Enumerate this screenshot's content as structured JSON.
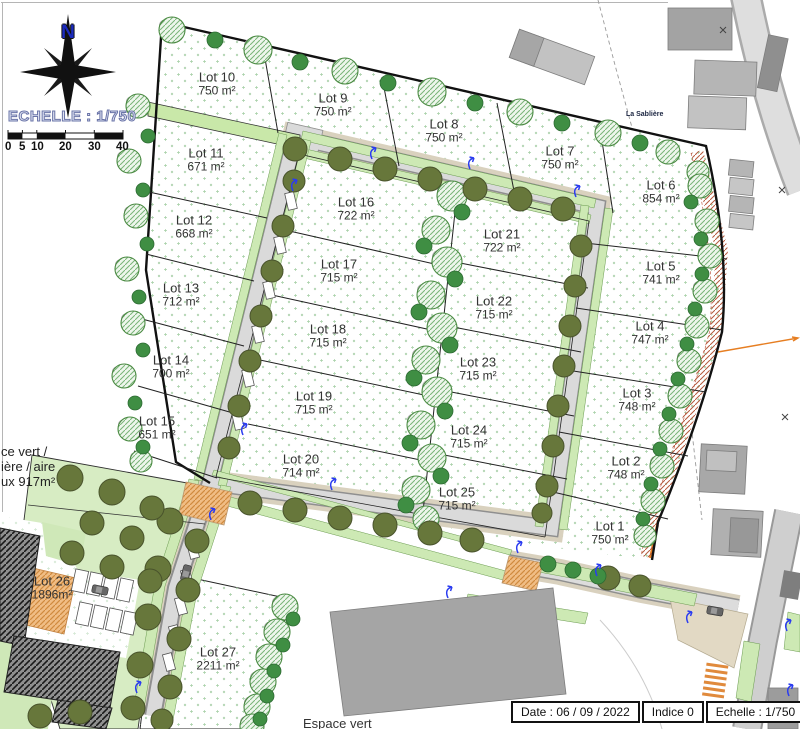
{
  "compass": {
    "north_label": "N"
  },
  "scale": {
    "title": "ECHELLE : 1/750",
    "tick_labels": [
      "0",
      "5",
      "10",
      "20",
      "30",
      "40"
    ]
  },
  "road_label": "La Sablière",
  "green_area_note": {
    "line1": "ce vert /",
    "line2": "ière / aire",
    "line3": "ux 917m²"
  },
  "espace_vert_label": "Espace vert",
  "title_block": {
    "date": "Date : 06 / 09 / 2022",
    "indice": "Indice 0",
    "echelle": "Echelle : 1/750"
  },
  "colors": {
    "lamp_symbol": "#2b3cf0",
    "orange_marking": "#e8a05a",
    "tree_green": "#3f8e43",
    "scale_text_outline": "#6a74a8"
  },
  "lots": [
    {
      "name": "Lot 1",
      "area": "750 m²",
      "x": 610,
      "y": 533
    },
    {
      "name": "Lot 2",
      "area": "748 m²",
      "x": 626,
      "y": 468
    },
    {
      "name": "Lot 3",
      "area": "748 m²",
      "x": 637,
      "y": 400
    },
    {
      "name": "Lot 4",
      "area": "747 m²",
      "x": 650,
      "y": 333
    },
    {
      "name": "Lot 5",
      "area": "741 m²",
      "x": 661,
      "y": 273
    },
    {
      "name": "Lot 6",
      "area": "854 m²",
      "x": 661,
      "y": 192
    },
    {
      "name": "Lot 7",
      "area": "750 m²",
      "x": 560,
      "y": 158
    },
    {
      "name": "Lot 8",
      "area": "750 m²",
      "x": 444,
      "y": 131
    },
    {
      "name": "Lot 9",
      "area": "750 m²",
      "x": 333,
      "y": 105
    },
    {
      "name": "Lot 10",
      "area": "750 m²",
      "x": 217,
      "y": 84
    },
    {
      "name": "Lot 11",
      "area": "671 m²",
      "x": 206,
      "y": 160
    },
    {
      "name": "Lot 12",
      "area": "668 m²",
      "x": 194,
      "y": 227
    },
    {
      "name": "Lot 13",
      "area": "712 m²",
      "x": 181,
      "y": 295
    },
    {
      "name": "Lot 14",
      "area": "700 m²",
      "x": 171,
      "y": 367
    },
    {
      "name": "Lot 15",
      "area": "651 m²",
      "x": 157,
      "y": 428
    },
    {
      "name": "Lot 16",
      "area": "722 m²",
      "x": 356,
      "y": 209
    },
    {
      "name": "Lot 17",
      "area": "715 m²",
      "x": 339,
      "y": 271
    },
    {
      "name": "Lot 18",
      "area": "715 m²",
      "x": 328,
      "y": 336
    },
    {
      "name": "Lot 19",
      "area": "715 m²",
      "x": 314,
      "y": 403
    },
    {
      "name": "Lot 20",
      "area": "714 m²",
      "x": 301,
      "y": 466
    },
    {
      "name": "Lot 21",
      "area": "722 m²",
      "x": 502,
      "y": 241
    },
    {
      "name": "Lot 22",
      "area": "715 m²",
      "x": 494,
      "y": 308
    },
    {
      "name": "Lot 23",
      "area": "715 m²",
      "x": 478,
      "y": 369
    },
    {
      "name": "Lot 24",
      "area": "715 m²",
      "x": 469,
      "y": 437
    },
    {
      "name": "Lot 25",
      "area": "715 m²",
      "x": 457,
      "y": 499
    },
    {
      "name": "Lot 26",
      "area": "1896m²",
      "x": 52,
      "y": 588
    },
    {
      "name": "Lot 27",
      "area": "2211 m²",
      "x": 218,
      "y": 659
    }
  ]
}
